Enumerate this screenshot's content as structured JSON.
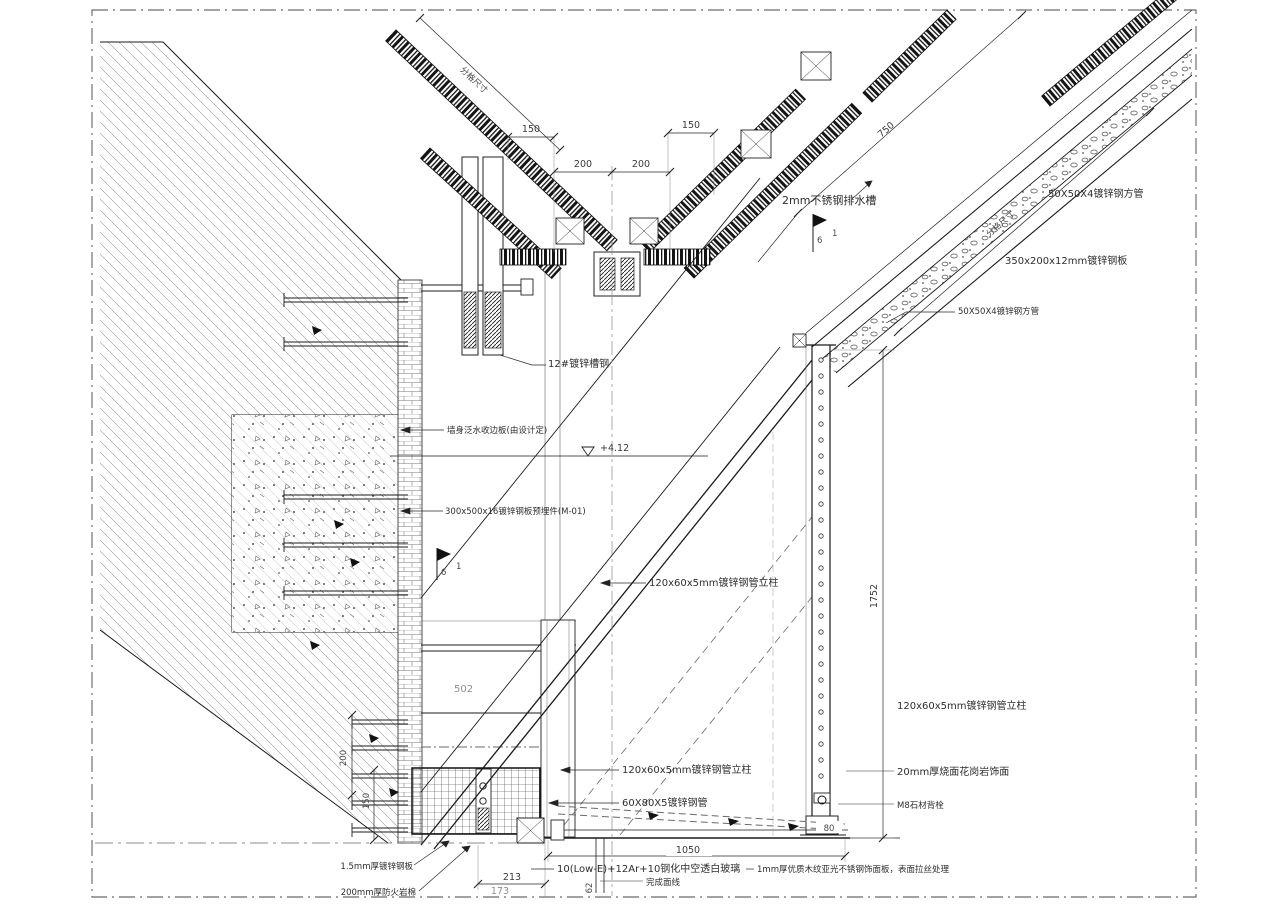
{
  "drawing": {
    "annotations": {
      "gutter": "2mm不锈钢排水槽",
      "square_tube_top": "50X50X4镀锌钢方管",
      "steel_plate_350": "350x200x12mm镀锌钢板",
      "square_tube_mid": "50X50X4镀锌钢方管",
      "channel_12": "12#镀锌槽钢",
      "wall_flashing": "墙身泛水收边板(由设计定)",
      "embed_plate": "300x500x16镀锌钢板预埋件(M-01)",
      "column_mid": "120x60x5mm镀锌钢管立柱",
      "column_right": "120x60x5mm镀锌钢管立柱",
      "granite_finish": "20mm厚烧面花岗岩饰面",
      "stone_bolt": "M8石材背栓",
      "column_bottom": "120x60x5mm镀锌钢管立柱",
      "tube_60x80": "60X80X5镀锌钢管",
      "glass": "10(Low-E)+12Ar+10钢化中空透白玻璃",
      "finish_line": "完成面线",
      "stainless_panel": "1mm厚优质木纹亚光不锈钢饰面板，表面拉丝处理",
      "galv_sheet": "1.5mm厚镀锌钢板",
      "rockwool": "200mm厚防火岩棉",
      "member_tag": "502"
    },
    "dimensions": {
      "top_left_150": "150",
      "top_mid_left_200": "200",
      "top_mid_right_200": "200",
      "top_right_150": "150",
      "roof_750": "750",
      "grid_label_right": "分格尺寸",
      "grid_label_left": "分格尺寸",
      "wall_height_1752": "1752",
      "wall_200": "200",
      "wall_150": "150",
      "floor_1050": "1050",
      "floor_80": "80",
      "bottom_213": "213",
      "bottom_173": "173",
      "bottom_62": "62"
    },
    "levels": {
      "roof_level": "+4.12"
    },
    "weld_marks": {
      "size": "6",
      "count": "1"
    }
  }
}
